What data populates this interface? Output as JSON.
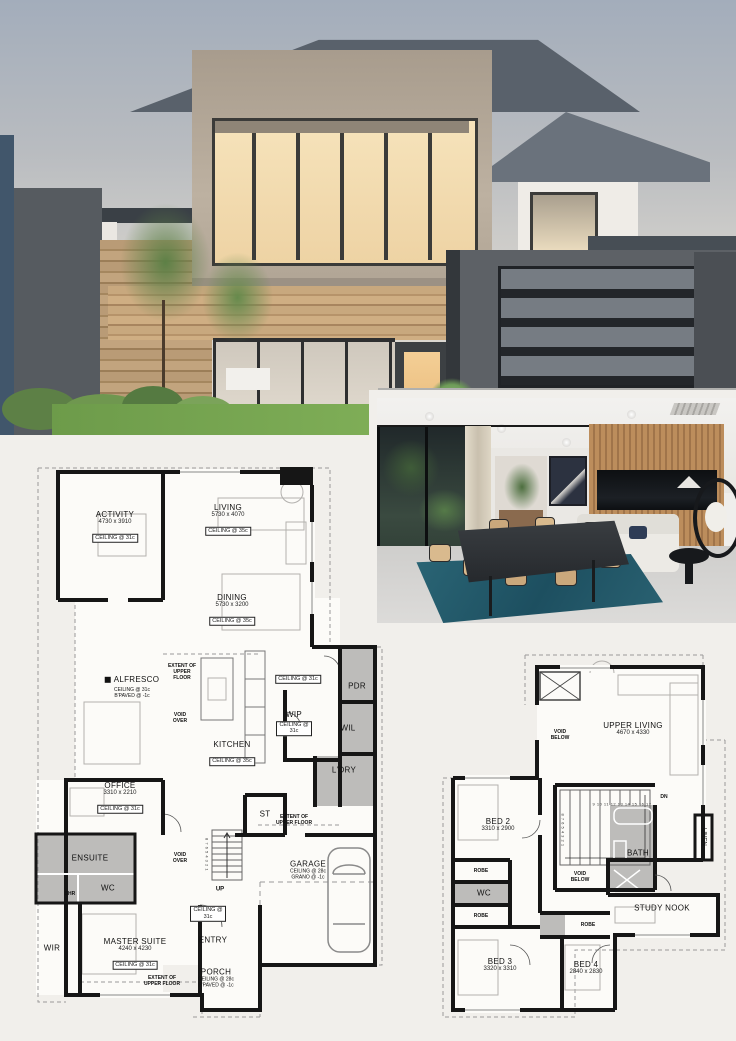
{
  "ground": {
    "activity": {
      "name": "ACTIVITY",
      "dims": "4730 x 3910",
      "ceil": "CEILING @ 31c"
    },
    "living": {
      "name": "LIVING",
      "dims": "5730 x 4070",
      "ceil": "CEILING @ 35c"
    },
    "dining": {
      "name": "DINING",
      "dims": "5730 x 3200",
      "ceil": "CEILING @ 35c"
    },
    "alfresco": {
      "name": "ALFRESCO",
      "ceil": "CEILING @ 31c",
      "paved": "B'PAVED @ -1c"
    },
    "extent_upper": "EXTENT OF UPPER FLOOR",
    "void_over": "VOID OVER",
    "hall_ceil": "CEILING @ 31c",
    "pdr": "PDR",
    "wip": {
      "name": "WIP",
      "ceil": "CEILING @ 31c"
    },
    "wil": "WIL",
    "kitchen": {
      "name": "KITCHEN",
      "ceil": "CEILING @ 35c"
    },
    "ldry": "L'DRY",
    "office": {
      "name": "OFFICE",
      "dims": "3310 x 2210",
      "ceil": "CEILING @ 31c"
    },
    "st": "ST",
    "up": "UP",
    "stair_numbers": "8 7 6 5 4 3 2 1",
    "ensuite": "ENSUITE",
    "shr": "SHR",
    "wc": "WC",
    "entry_ceil": "CEILING @ 31c",
    "entry": "ENTRY",
    "garage": {
      "name": "GARAGE",
      "ceil": "CEILING @ 28c",
      "grano": "GRANO @ -1c"
    },
    "wir": "WIR",
    "master": {
      "name": "MASTER SUITE",
      "dims": "4240 x 4230",
      "ceil": "CEILING @ 31c"
    },
    "porch": {
      "name": "PORCH",
      "ceil": "CEILING @ 28c",
      "paved": "B'PAVED @ -1c"
    }
  },
  "upper": {
    "void_below": "VOID BELOW",
    "upper_living": {
      "name": "UPPER LIVING",
      "dims": "4670 x 4330"
    },
    "dn": "DN",
    "stair_run_upper": "9 10 11 12 13 14 15 16 17",
    "stair_run_lower": "8 7 6 5 4 3 2 1",
    "bed2": {
      "name": "BED 2",
      "dims": "3310 x 2900"
    },
    "bath": "BATH",
    "linen": "LINEN",
    "robe": "ROBE",
    "wc": "WC",
    "study_nook": "STUDY NOOK",
    "bed3": {
      "name": "BED 3",
      "dims": "3320 x 3310"
    },
    "bed4": {
      "name": "BED 4",
      "dims": "2840 x 2830"
    }
  },
  "colors": {
    "plan_wall": "#161616",
    "wet_area_fill": "#bdbcba",
    "page_bg": "#f1efeb",
    "rug_teal": "#2a6575",
    "timber": "#b98a5a",
    "grass": "#6f9e4c",
    "sky": "#a3adbb"
  }
}
